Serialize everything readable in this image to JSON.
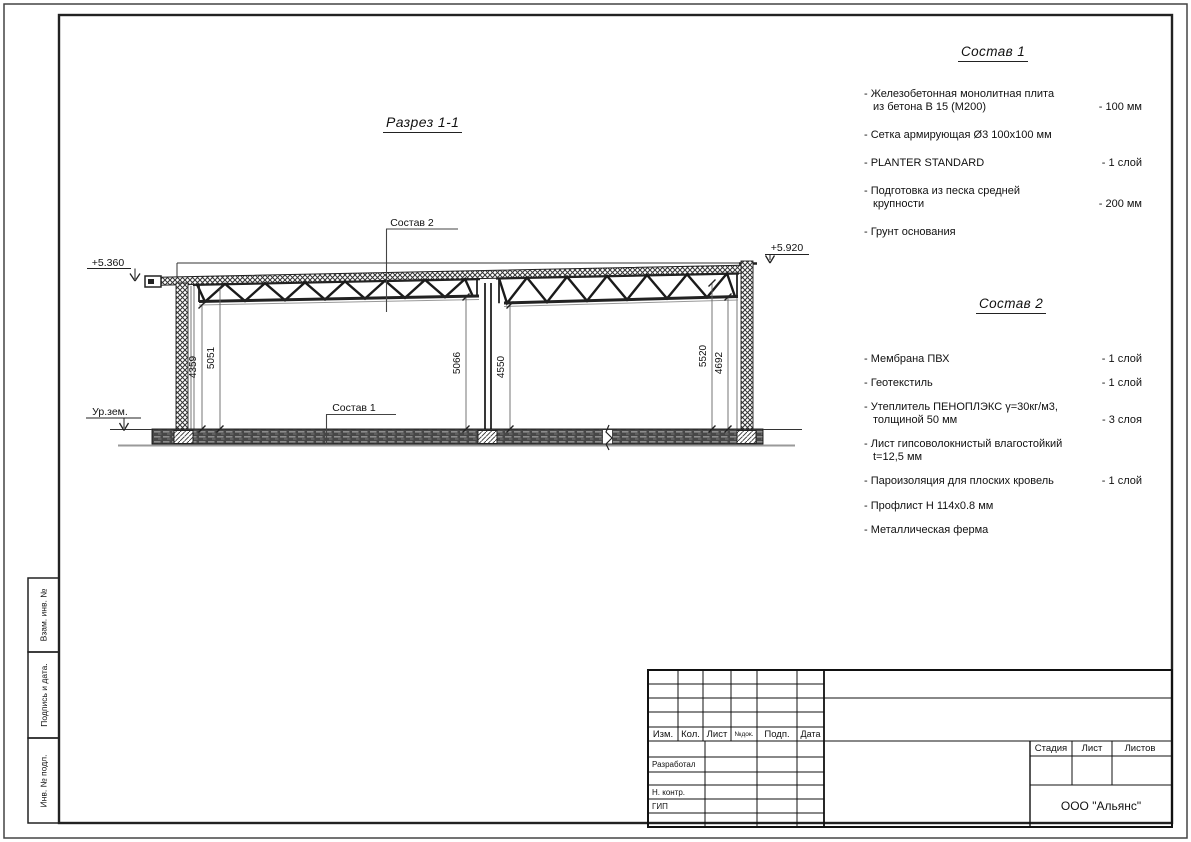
{
  "drawing": {
    "title": "Разрез 1-1",
    "elevation_left": "+5.360",
    "elevation_right": "+5.920",
    "ground_level_label": "Ур.зем.",
    "callout_sostav_1": "Состав 1",
    "callout_sostav_2": "Состав 2",
    "dimensions": [
      "4359",
      "5051",
      "5066",
      "4550",
      "5520",
      "4692"
    ]
  },
  "sostav1": {
    "heading": "Состав 1",
    "items": [
      {
        "name": "- Железобетонная  монолитная плита\nиз бетона В 15 (М200)",
        "value": "- 100 мм"
      },
      {
        "name": "- Сетка армирующая Ø3 100х100 мм",
        "value": ""
      },
      {
        "name": "- PLANTER STANDARD",
        "value": "- 1  слой"
      },
      {
        "name": "- Подготовка из песка средней\nкрупности",
        "value": "- 200 мм"
      },
      {
        "name": "- Грунт основания",
        "value": ""
      }
    ]
  },
  "sostav2": {
    "heading": "Состав 2",
    "items": [
      {
        "name": "- Мембрана ПВХ",
        "value": "- 1 слой"
      },
      {
        "name": "- Геотекстиль",
        "value": "- 1 слой"
      },
      {
        "name": "- Утеплитель ПЕНОПЛЭКС γ=30кг/м3,\nтолщиной 50 мм",
        "value": "- 3 слоя"
      },
      {
        "name": "- Лист гипсоволокнистый влагостойкий\nt=12,5 мм",
        "value": ""
      },
      {
        "name": "- Пароизоляция для плоских кровель",
        "value": "- 1 слой"
      },
      {
        "name": "- Профлист Н 114х0.8 мм",
        "value": ""
      },
      {
        "name": "- Металлическая ферма",
        "value": ""
      }
    ]
  },
  "titleblock": {
    "rev_headers": [
      "Изм.",
      "Кол.",
      "Лист",
      "№док.",
      "Подп.",
      "Дата"
    ],
    "roles": [
      "Разработал",
      "Н. контр.",
      "ГИП"
    ],
    "stage_headers": [
      "Стадия",
      "Лист",
      "Листов"
    ],
    "company": "ООО \"Альянс\""
  },
  "stamp_column": {
    "labels": [
      "Взам. инв. №",
      "Подпись и дата.",
      "Инв. № подл."
    ]
  }
}
